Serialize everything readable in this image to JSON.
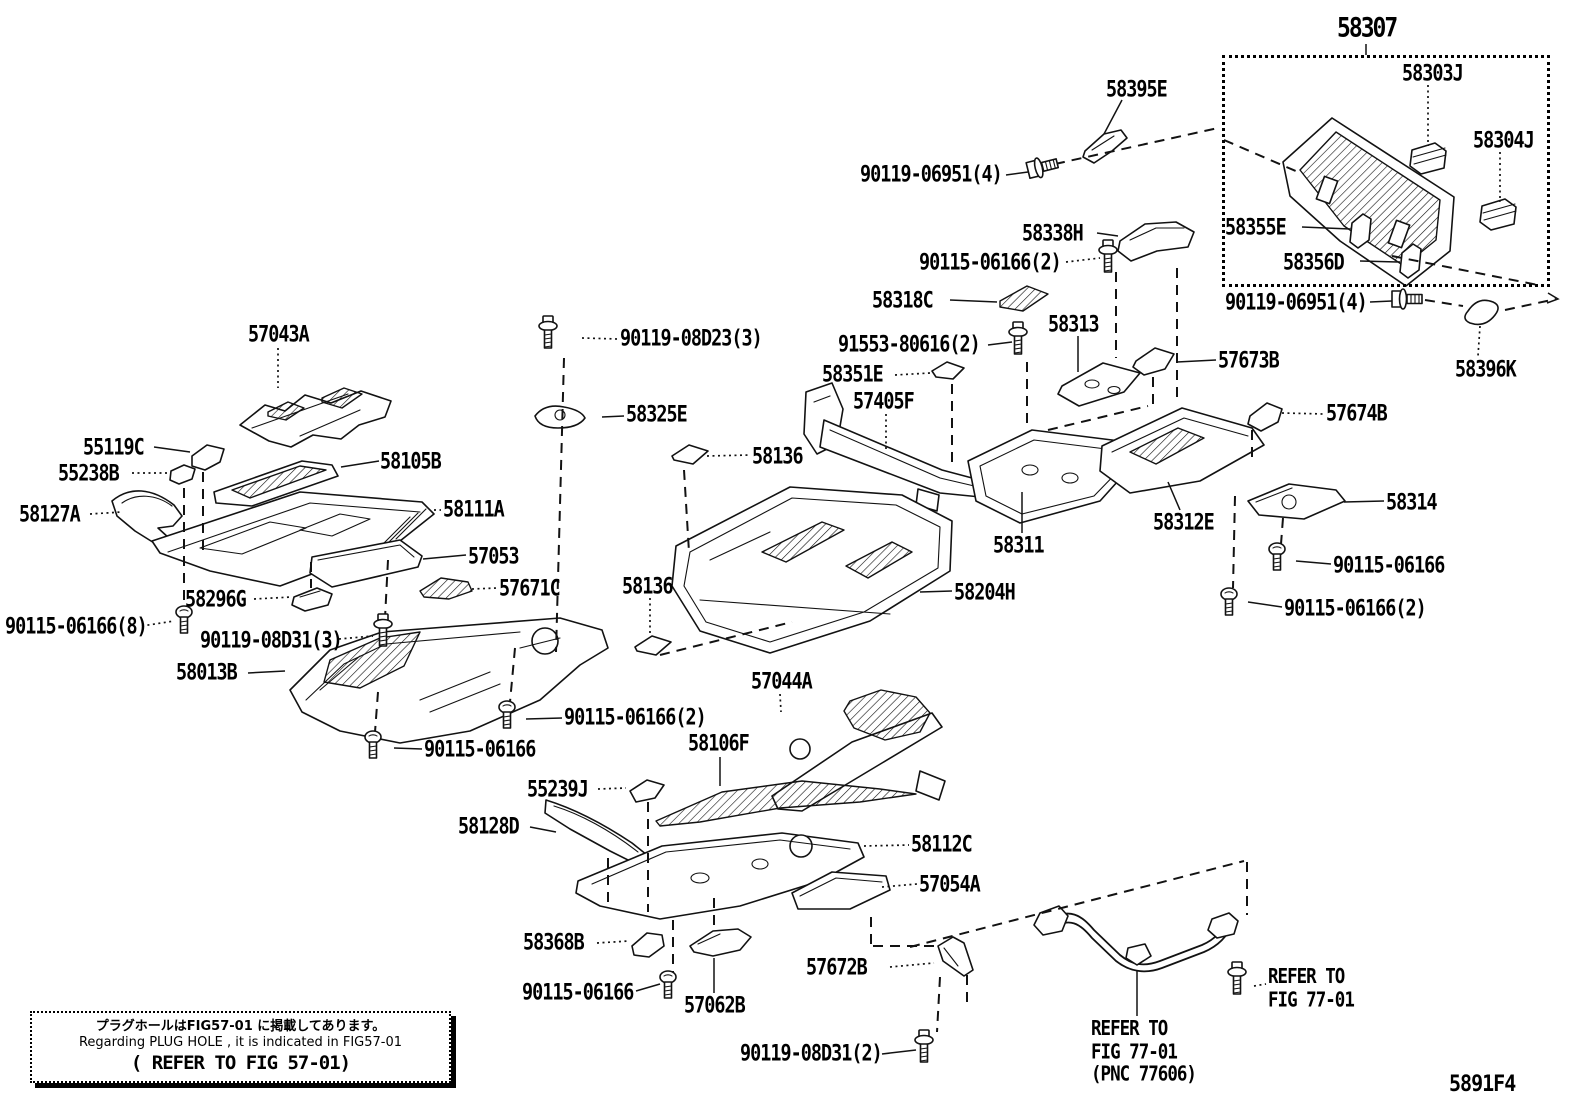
{
  "diagram": {
    "figure_code": "5891F4",
    "inset_title": "58307",
    "line_color": "#121212",
    "background": "#ffffff",
    "note_box": {
      "line1": "プラグホールはFIG57-01 に掲載してあります。",
      "line2": "Regarding PLUG HOLE , it is indicated in FIG57-01",
      "line3": "( REFER TO FIG 57-01)"
    },
    "refer_right": {
      "line1": "REFER TO",
      "line2": "FIG 77-01"
    },
    "refer_pnc": {
      "line1": "REFER TO",
      "line2": "FIG 77-01",
      "line3": "(PNC 77606)"
    }
  },
  "labels": [
    {
      "text": "58303J",
      "x": 1402,
      "y": 63
    },
    {
      "text": "58304J",
      "x": 1473,
      "y": 130
    },
    {
      "text": "58355E",
      "x": 1225,
      "y": 217
    },
    {
      "text": "58356D",
      "x": 1283,
      "y": 252
    },
    {
      "text": "90119-06951(4)",
      "x": 1225,
      "y": 292
    },
    {
      "text": "58396K",
      "x": 1455,
      "y": 359
    },
    {
      "text": "58395E",
      "x": 1106,
      "y": 79
    },
    {
      "text": "90119-06951(4)",
      "x": 860,
      "y": 164
    },
    {
      "text": "58338H",
      "x": 1022,
      "y": 223
    },
    {
      "text": "90115-06166(2)",
      "x": 919,
      "y": 252
    },
    {
      "text": "58318C",
      "x": 872,
      "y": 290
    },
    {
      "text": "91553-80616(2)",
      "x": 838,
      "y": 334
    },
    {
      "text": "58313",
      "x": 1048,
      "y": 314
    },
    {
      "text": "57673B",
      "x": 1218,
      "y": 350
    },
    {
      "text": "58351E",
      "x": 822,
      "y": 364
    },
    {
      "text": "57405F",
      "x": 853,
      "y": 391
    },
    {
      "text": "57674B",
      "x": 1326,
      "y": 403
    },
    {
      "text": "90119-08D23(3)",
      "x": 620,
      "y": 328
    },
    {
      "text": "58325E",
      "x": 626,
      "y": 404
    },
    {
      "text": "57043A",
      "x": 248,
      "y": 324
    },
    {
      "text": "55119C",
      "x": 83,
      "y": 437
    },
    {
      "text": "55238B",
      "x": 58,
      "y": 463
    },
    {
      "text": "58105B",
      "x": 380,
      "y": 451
    },
    {
      "text": "58127A",
      "x": 19,
      "y": 504
    },
    {
      "text": "58111A",
      "x": 443,
      "y": 499
    },
    {
      "text": "58136",
      "x": 752,
      "y": 446
    },
    {
      "text": "57053",
      "x": 468,
      "y": 546
    },
    {
      "text": "57671C",
      "x": 499,
      "y": 578
    },
    {
      "text": "58296G",
      "x": 185,
      "y": 589
    },
    {
      "text": "58136",
      "x": 622,
      "y": 576
    },
    {
      "text": "58311",
      "x": 993,
      "y": 535
    },
    {
      "text": "58204H",
      "x": 954,
      "y": 582
    },
    {
      "text": "58312E",
      "x": 1153,
      "y": 512
    },
    {
      "text": "58314",
      "x": 1386,
      "y": 492
    },
    {
      "text": "90115-06166",
      "x": 1333,
      "y": 555
    },
    {
      "text": "90115-06166(2)",
      "x": 1284,
      "y": 598
    },
    {
      "text": "90115-06166(8)",
      "x": 5,
      "y": 616
    },
    {
      "text": "90119-08D31(3)",
      "x": 200,
      "y": 630
    },
    {
      "text": "58013B",
      "x": 176,
      "y": 662
    },
    {
      "text": "90115-06166(2)",
      "x": 564,
      "y": 707
    },
    {
      "text": "90115-06166",
      "x": 424,
      "y": 739
    },
    {
      "text": "57044A",
      "x": 751,
      "y": 671
    },
    {
      "text": "58106F",
      "x": 688,
      "y": 733
    },
    {
      "text": "55239J",
      "x": 527,
      "y": 779
    },
    {
      "text": "58128D",
      "x": 458,
      "y": 816
    },
    {
      "text": "58112C",
      "x": 911,
      "y": 834
    },
    {
      "text": "57054A",
      "x": 919,
      "y": 874
    },
    {
      "text": "58368B",
      "x": 523,
      "y": 932
    },
    {
      "text": "90115-06166",
      "x": 522,
      "y": 982
    },
    {
      "text": "57062B",
      "x": 684,
      "y": 995
    },
    {
      "text": "57672B",
      "x": 806,
      "y": 957
    },
    {
      "text": "90119-08D31(2)",
      "x": 740,
      "y": 1043
    }
  ]
}
